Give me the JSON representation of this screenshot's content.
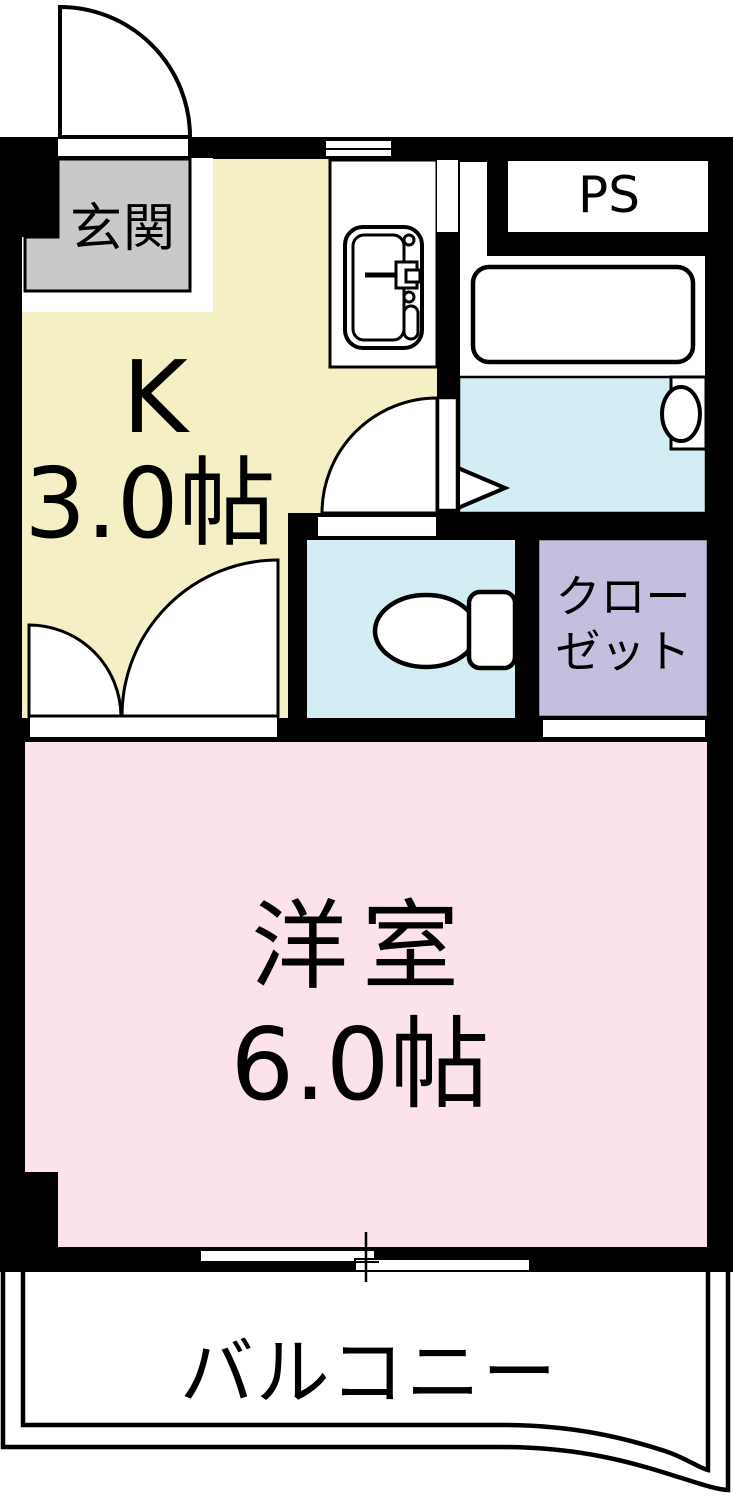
{
  "plan_title": "1K apartment floor plan",
  "rooms": {
    "genkan": {
      "label": "玄関"
    },
    "kitchen": {
      "label": "K",
      "size": "3.0帖"
    },
    "ps": {
      "label": "PS"
    },
    "bathroom": {
      "label": ""
    },
    "toilet": {
      "label": ""
    },
    "closet": {
      "label_line1": "クロー",
      "label_line2": "ゼット"
    },
    "western_room": {
      "label": "洋室",
      "size": "6.0帖"
    },
    "balcony": {
      "label": "バルコニー"
    }
  },
  "colors": {
    "wall": "#000000",
    "kitchen": "#f5efc5",
    "genkan": "#c9c9c9",
    "water_blue": "#d4ecf4",
    "closet_purple": "#c2bfdf",
    "room_pink": "#fce2ec",
    "white": "#ffffff"
  }
}
